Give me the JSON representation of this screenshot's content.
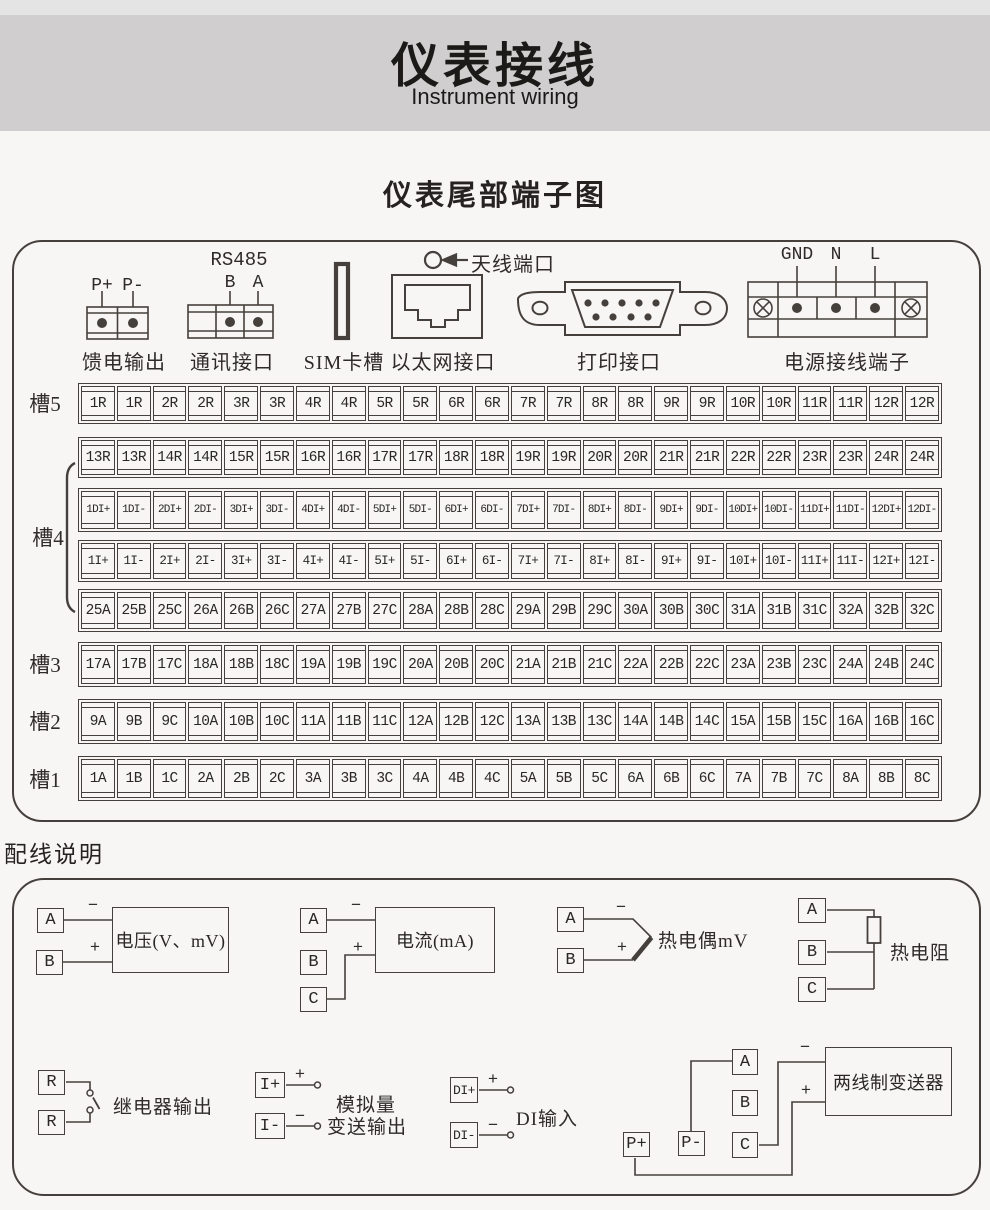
{
  "header": {
    "title": "仪表接线",
    "subtitle": "Instrument wiring"
  },
  "section_title": "仪表尾部端子图",
  "colors": {
    "line": "#46403c",
    "band": "#d0cecf",
    "band_top": "#e5e4e4",
    "background": "#f7f6f5"
  },
  "connectors": {
    "feed_output": {
      "caption": "馈电输出",
      "pins": [
        "P+",
        "P-"
      ]
    },
    "comm": {
      "caption": "通讯接口",
      "title": "RS485",
      "pins": [
        "B",
        "A"
      ]
    },
    "sim": {
      "caption": "SIM卡槽"
    },
    "ethernet": {
      "caption": "以太网接口",
      "antenna_label": "天线端口"
    },
    "printer": {
      "caption": "打印接口"
    },
    "power": {
      "caption": "电源接线端子",
      "pins": [
        "GND",
        "N",
        "L"
      ]
    }
  },
  "slots": {
    "labels": [
      "槽5",
      "槽4",
      "槽3",
      "槽2",
      "槽1"
    ]
  },
  "strips": [
    {
      "cells": [
        "1R",
        "1R",
        "2R",
        "2R",
        "3R",
        "3R",
        "4R",
        "4R",
        "5R",
        "5R",
        "6R",
        "6R",
        "7R",
        "7R",
        "8R",
        "8R",
        "9R",
        "9R",
        "10R",
        "10R",
        "11R",
        "11R",
        "12R",
        "12R"
      ]
    },
    {
      "cells": [
        "13R",
        "13R",
        "14R",
        "14R",
        "15R",
        "15R",
        "16R",
        "16R",
        "17R",
        "17R",
        "18R",
        "18R",
        "19R",
        "19R",
        "20R",
        "20R",
        "21R",
        "21R",
        "22R",
        "22R",
        "23R",
        "23R",
        "24R",
        "24R"
      ]
    },
    {
      "cells": [
        "1DI+",
        "1DI-",
        "2DI+",
        "2DI-",
        "3DI+",
        "3DI-",
        "4DI+",
        "4DI-",
        "5DI+",
        "5DI-",
        "6DI+",
        "6DI-",
        "7DI+",
        "7DI-",
        "8DI+",
        "8DI-",
        "9DI+",
        "9DI-",
        "10DI+",
        "10DI-",
        "11DI+",
        "11DI-",
        "12DI+",
        "12DI-"
      ]
    },
    {
      "cells": [
        "1I+",
        "1I-",
        "2I+",
        "2I-",
        "3I+",
        "3I-",
        "4I+",
        "4I-",
        "5I+",
        "5I-",
        "6I+",
        "6I-",
        "7I+",
        "7I-",
        "8I+",
        "8I-",
        "9I+",
        "9I-",
        "10I+",
        "10I-",
        "11I+",
        "11I-",
        "12I+",
        "12I-"
      ]
    },
    {
      "cells": [
        "25A",
        "25B",
        "25C",
        "26A",
        "26B",
        "26C",
        "27A",
        "27B",
        "27C",
        "28A",
        "28B",
        "28C",
        "29A",
        "29B",
        "29C",
        "30A",
        "30B",
        "30C",
        "31A",
        "31B",
        "31C",
        "32A",
        "32B",
        "32C"
      ]
    },
    {
      "cells": [
        "17A",
        "17B",
        "17C",
        "18A",
        "18B",
        "18C",
        "19A",
        "19B",
        "19C",
        "20A",
        "20B",
        "20C",
        "21A",
        "21B",
        "21C",
        "22A",
        "22B",
        "22C",
        "23A",
        "23B",
        "23C",
        "24A",
        "24B",
        "24C"
      ]
    },
    {
      "cells": [
        "9A",
        "9B",
        "9C",
        "10A",
        "10B",
        "10C",
        "11A",
        "11B",
        "11C",
        "12A",
        "12B",
        "12C",
        "13A",
        "13B",
        "13C",
        "14A",
        "14B",
        "14C",
        "15A",
        "15B",
        "15C",
        "16A",
        "16B",
        "16C"
      ]
    },
    {
      "cells": [
        "1A",
        "1B",
        "1C",
        "2A",
        "2B",
        "2C",
        "3A",
        "3B",
        "3C",
        "4A",
        "4B",
        "4C",
        "5A",
        "5B",
        "5C",
        "6A",
        "6B",
        "6C",
        "7A",
        "7B",
        "7C",
        "8A",
        "8B",
        "8C"
      ]
    }
  ],
  "wiring": {
    "heading": "配线说明",
    "voltage": {
      "a": "A",
      "b": "B",
      "box": "电压(V、mV)",
      "minus": "−",
      "plus": "+"
    },
    "current": {
      "a": "A",
      "b": "B",
      "c": "C",
      "box": "电流(mA)",
      "minus": "−",
      "plus": "+"
    },
    "thermocouple": {
      "a": "A",
      "b": "B",
      "label": "热电偶mV",
      "minus": "−",
      "plus": "+"
    },
    "rtd": {
      "a": "A",
      "b": "B",
      "c": "C",
      "label": "热电阻"
    },
    "relay": {
      "r1": "R",
      "r2": "R",
      "label": "继电器输出"
    },
    "analog_out": {
      "ip": "I+",
      "im": "I-",
      "label1": "模拟量",
      "label2": "变送输出",
      "plus": "+",
      "minus": "−"
    },
    "di": {
      "dip": "DI+",
      "dim": "DI-",
      "label": "DI输入",
      "plus": "+",
      "minus": "−"
    },
    "transmitter": {
      "a": "A",
      "b": "B",
      "c": "C",
      "pp": "P+",
      "pm": "P-",
      "box": "两线制变送器",
      "minus": "−",
      "plus": "+"
    }
  }
}
